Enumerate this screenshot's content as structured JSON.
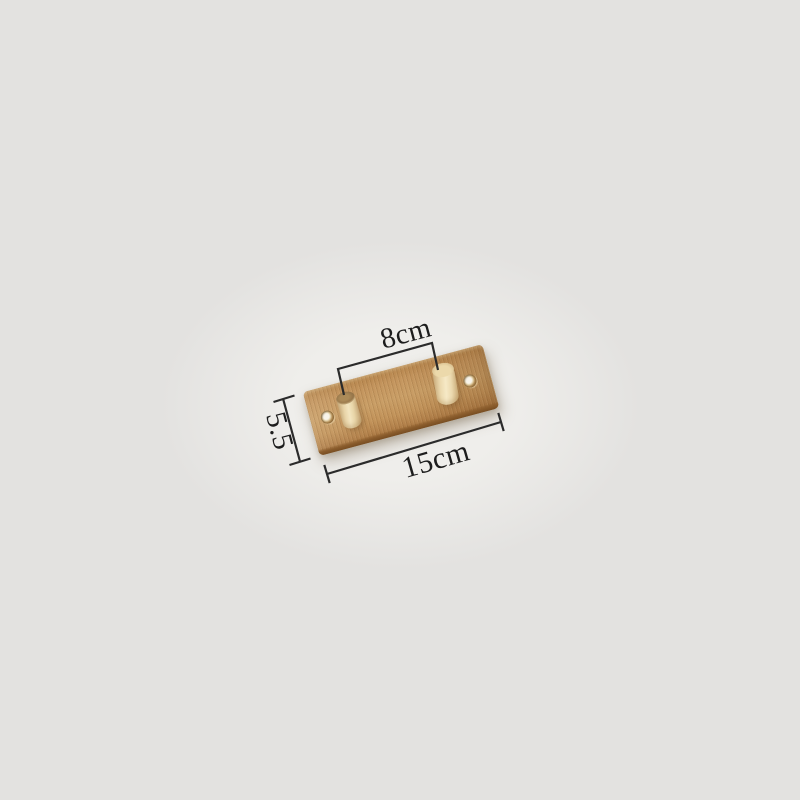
{
  "image": {
    "type": "product-photograph-with-dimensions",
    "subject": "Bamboo wall-mounted hook rail with two round wooden pegs and two screw holes, shown tilted on a plain light grey background",
    "background_color": "#e3e2e0",
    "backdrop_color": "#efeeeb"
  },
  "annotations": {
    "line_color": "#2b2b2b",
    "text_color": "#1d1d1d",
    "peg_distance": {
      "label": "8cm"
    },
    "board_width": {
      "label": "15cm"
    },
    "board_height": {
      "label": "5.5"
    }
  },
  "materials": {
    "plank_wood_color": "#c2945c",
    "plank_edge_color": "#845627",
    "peg_body_color": "#eedaae",
    "left_peg_top_color": "#97764a",
    "right_peg_top_color": "#e7d4a6",
    "screw_hole_color": "#f7f3e8"
  }
}
